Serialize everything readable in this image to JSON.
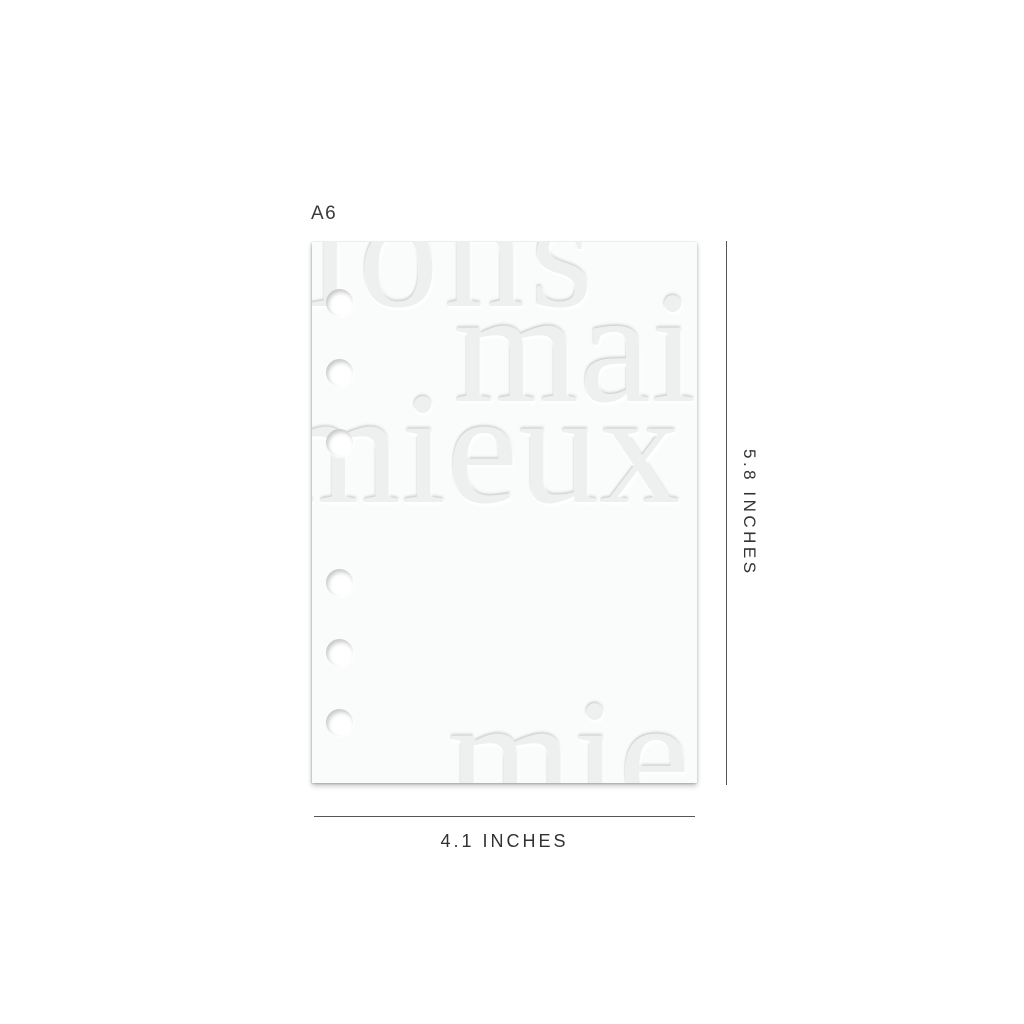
{
  "labels": {
    "size": "A6",
    "height": "5.8 INCHES",
    "width": "4.1 INCHES"
  },
  "emboss": {
    "fragments": [
      "ions",
      "mai",
      "mieux",
      "mie"
    ]
  },
  "page": {
    "holes_count": 6
  },
  "colors": {
    "background": "#ffffff",
    "page": "#fafbfb",
    "emboss_text": "#eef0f0",
    "dimension_text": "#323232",
    "dimension_line": "#565656",
    "size_tag_text": "#3a3a3a"
  }
}
